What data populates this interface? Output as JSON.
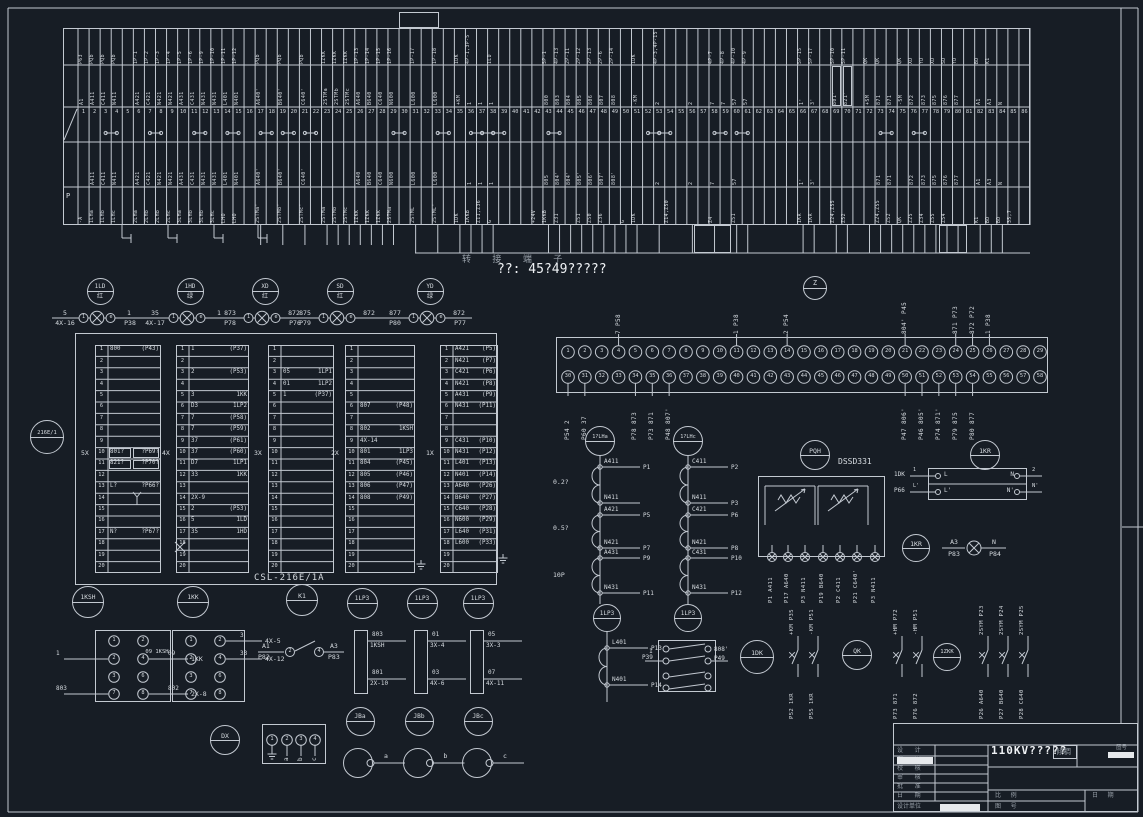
{
  "note_text": "??: 45?49?????",
  "bridge_text": "转 接 端 子",
  "strip": {
    "header_p": "P",
    "jumpers": [
      3,
      7,
      11,
      14,
      17,
      19,
      21,
      29,
      33,
      36,
      37,
      38,
      43,
      52,
      53,
      58,
      60,
      73,
      76
    ],
    "boxed": [
      69,
      70
    ],
    "columns": [
      [
        "1",
        "P63",
        "A1",
        "",
        "-A"
      ],
      [
        "2",
        "PQb",
        "A411",
        "A411",
        "1LHa"
      ],
      [
        "3",
        "PQb",
        "C411",
        "C411",
        "1LHb"
      ],
      [
        "4",
        "PQb",
        "N411",
        "N411",
        "1LHc"
      ],
      [
        "5",
        "",
        "",
        "",
        ""
      ],
      [
        "6",
        "1P-1",
        "A421",
        "A421",
        "2LHa"
      ],
      [
        "7",
        "1P-2",
        "C421",
        "C421",
        "2LHb"
      ],
      [
        "8",
        "1P-3",
        "N421",
        "N421",
        "2LHb"
      ],
      [
        "9",
        "1P-4",
        "N421",
        "N421",
        "2LHc"
      ],
      [
        "10",
        "1P-5",
        "A431",
        "A431",
        "3LHa"
      ],
      [
        "11",
        "1P-6",
        "C431",
        "C431",
        "3LHb"
      ],
      [
        "12",
        "1P-9",
        "N431",
        "N431",
        "3LHb"
      ],
      [
        "13",
        "1P-10",
        "N431",
        "N431",
        "3LHc"
      ],
      [
        "14",
        "1P-11",
        "L401",
        "L401",
        "LHO"
      ],
      [
        "15",
        "1P-12",
        "N401",
        "N401",
        "LHO"
      ],
      [
        "16",
        "",
        "",
        "",
        ""
      ],
      [
        "17",
        "PQb",
        "A640'",
        "A640'",
        "2STMa'"
      ],
      [
        "18",
        "",
        "",
        "",
        ""
      ],
      [
        "19",
        "PQb",
        "B640'",
        "B640'",
        "2STMb'"
      ],
      [
        "20",
        "",
        "",
        "",
        ""
      ],
      [
        "21",
        "PQb",
        "C640'",
        "C640'",
        "2STMc'"
      ],
      [
        "22",
        "",
        "",
        "",
        ""
      ],
      [
        "23",
        "1ZKK",
        "2STMa",
        "",
        "2STMa"
      ],
      [
        "24",
        "1ZKK",
        "2STMb",
        "",
        "2STMb"
      ],
      [
        "25",
        "1ZKK",
        "2STMc",
        "",
        "2STMc"
      ],
      [
        "26",
        "1P-13",
        "A640",
        "A640",
        "1ZKK"
      ],
      [
        "27",
        "1P-14",
        "B640",
        "B640",
        "1ZKK"
      ],
      [
        "28",
        "1P-15",
        "C640",
        "C640",
        "1ZKK"
      ],
      [
        "29",
        "1P-16",
        "N600",
        "N600",
        "2STMa"
      ],
      [
        "30",
        "",
        "",
        "",
        ""
      ],
      [
        "31",
        "1P-17",
        "L600",
        "L600",
        "2STML"
      ],
      [
        "32",
        "",
        "",
        "",
        ""
      ],
      [
        "33",
        "1P-18",
        "L600",
        "L600",
        "2STML'"
      ],
      [
        "34",
        "",
        "",
        "",
        ""
      ],
      [
        "35",
        "1DK",
        "+KM",
        "",
        "1DK"
      ],
      [
        "36",
        "4P-1,3P-5",
        "1",
        "1",
        "1KKB"
      ],
      [
        "37",
        "",
        "1",
        "1",
        "Z11,Z36"
      ],
      [
        "38",
        "1LD",
        "1",
        "1",
        "G"
      ],
      [
        "39",
        "",
        "",
        "",
        ""
      ],
      [
        "40",
        "",
        "",
        "",
        ""
      ],
      [
        "41",
        "",
        "",
        "",
        ""
      ],
      [
        "42",
        "",
        "",
        "",
        "+24V"
      ],
      [
        "43",
        "5P-1",
        "800",
        "805",
        "1KKB"
      ],
      [
        "44",
        "4P-13",
        "803",
        "804'",
        "Z31"
      ],
      [
        "45",
        "2P-11",
        "804",
        "804'",
        ""
      ],
      [
        "46",
        "2P-12",
        "805",
        "805'",
        "Z51"
      ],
      [
        "47",
        "2P-13",
        "806",
        "806'",
        "Z50"
      ],
      [
        "48",
        "2P-6",
        "807",
        "807'",
        "Z36"
      ],
      [
        "49",
        "2P-14",
        "808",
        "808'",
        ""
      ],
      [
        "50",
        "",
        "",
        "",
        "G"
      ],
      [
        "51",
        "1DK",
        "-KM",
        "",
        "1DK"
      ],
      [
        "52",
        "",
        "",
        "",
        ""
      ],
      [
        "53",
        "4P-3,4P-15",
        "2",
        "2",
        ""
      ],
      [
        "54",
        "",
        "",
        "",
        "Z14,Z50"
      ],
      [
        "55",
        "",
        "",
        "",
        ""
      ],
      [
        "56",
        "",
        "2",
        "2",
        ""
      ],
      [
        "57",
        "",
        "",
        "",
        ""
      ],
      [
        "58",
        "4P-7",
        "7",
        "7",
        "Z4"
      ],
      [
        "59",
        "4P-8",
        "7",
        "",
        ""
      ],
      [
        "60",
        "4P-10",
        "57",
        "57",
        "Z51"
      ],
      [
        "61",
        "4P-9",
        "57",
        "",
        ""
      ],
      [
        "62",
        "",
        "",
        "",
        ""
      ],
      [
        "63",
        "",
        "",
        "",
        ""
      ],
      [
        "64",
        "",
        "",
        "",
        ""
      ],
      [
        "65",
        "",
        "",
        "",
        ""
      ],
      [
        "66",
        "5P-15",
        "1'",
        "1'",
        "1KR"
      ],
      [
        "67",
        "5P-17",
        "3'",
        "3'",
        "1KR"
      ],
      [
        "68",
        "",
        "",
        "",
        ""
      ],
      [
        "69",
        "5P-10",
        "801'",
        "",
        "Z24,Z55"
      ],
      [
        "70",
        "5P-11",
        "821'",
        "",
        "Z52"
      ],
      [
        "71",
        "",
        "",
        "",
        ""
      ],
      [
        "72",
        "QK",
        "+SM",
        "",
        ""
      ],
      [
        "73",
        "QK",
        "871",
        "871",
        "Z24,Z55"
      ],
      [
        "74",
        "",
        "871",
        "871",
        "Z52"
      ],
      [
        "75",
        "QK",
        "-SM",
        "",
        "QK"
      ],
      [
        "76",
        "XD",
        "872",
        "872",
        "Z25"
      ],
      [
        "77",
        "YD",
        "873",
        "873",
        "Z34"
      ],
      [
        "78",
        "XD",
        "875",
        "875",
        "Z55"
      ],
      [
        "79",
        "SD",
        "876",
        "876",
        "Z54"
      ],
      [
        "80",
        "YD",
        "877",
        "877",
        ""
      ],
      [
        "81",
        "",
        "",
        "",
        ""
      ],
      [
        "82",
        "BD",
        "A1",
        "A1",
        "K1"
      ],
      [
        "83",
        "K1",
        "A3",
        "A3",
        "BD"
      ],
      [
        "84",
        "",
        "N",
        "N",
        "BD"
      ],
      [
        "85",
        "",
        "",
        "",
        "35,7"
      ],
      [
        "86",
        "",
        "",
        "",
        ""
      ]
    ]
  },
  "lamps": [
    {
      "id": "1LD",
      "ch": "红",
      "lt": "5",
      "lb": "4X-16",
      "rt": "1",
      "rb": "P38"
    },
    {
      "id": "1HD",
      "ch": "绿",
      "lt": "35",
      "lb": "4X-17",
      "rt": "1",
      "rb": ""
    },
    {
      "id": "XD",
      "ch": "红",
      "lt": "873",
      "lb": "P78",
      "rt": "872",
      "rb": "P76"
    },
    {
      "id": "SD",
      "ch": "红",
      "lt": "875",
      "lb": "P79",
      "rt": "872",
      "rb": ""
    },
    {
      "id": "YD",
      "ch": "绿",
      "lt": "877",
      "lb": "P80",
      "rt": "872",
      "rb": "P77"
    }
  ],
  "device_left": "216E/1",
  "blocks": {
    "footer": "CSL-216E/1A",
    "items": [
      {
        "id": "5X",
        "x": 95,
        "w": 66,
        "rows": {
          "1": [
            "800",
            "(P43)"
          ],
          "10": [
            "801?",
            "?P69?",
            "box"
          ],
          "11": [
            "821?",
            "?P70?",
            "box"
          ],
          "13": [
            "L?",
            "?P66?"
          ],
          "17": [
            "N?",
            "?P67?"
          ]
        }
      },
      {
        "id": "4X",
        "x": 176,
        "w": 73,
        "rows": {
          "1": [
            "1",
            "(P37)"
          ],
          "3": [
            "2",
            "(P53)"
          ],
          "5": [
            "3",
            "1KK"
          ],
          "6": [
            "D3",
            "1LP2"
          ],
          "7": [
            "7",
            "(P58)"
          ],
          "8": [
            "7",
            "(P59)"
          ],
          "9": [
            "37",
            "(P61)"
          ],
          "10": [
            "37",
            "(P60)"
          ],
          "11": [
            "D7",
            "1LP1"
          ],
          "12": [
            "33",
            "1KK"
          ],
          "14": [
            "2X-9",
            ""
          ],
          "15": [
            "2",
            "(P53)"
          ],
          "16": [
            "5",
            "1LD"
          ],
          "17": [
            "35",
            "1HD"
          ]
        }
      },
      {
        "id": "3X",
        "x": 268,
        "w": 66,
        "rows": {
          "3": [
            "05",
            "1LP1"
          ],
          "4": [
            "01",
            "1LP2"
          ],
          "5": [
            "1",
            "(P37)"
          ]
        }
      },
      {
        "id": "2X",
        "x": 345,
        "w": 70,
        "rows": {
          "6": [
            "807",
            "(P48)"
          ],
          "8": [
            "802",
            "1KSH"
          ],
          "9": [
            "4X-14",
            ""
          ],
          "10": [
            "801",
            "1LP3"
          ],
          "11": [
            "804",
            "(P45)"
          ],
          "12": [
            "805",
            "(P46)"
          ],
          "13": [
            "806",
            "(P47)"
          ],
          "14": [
            "808",
            "(P49)"
          ]
        }
      },
      {
        "id": "1X",
        "x": 440,
        "w": 58,
        "rows": {
          "1": [
            "A421",
            "(P5)"
          ],
          "2": [
            "N421",
            "(P7)"
          ],
          "3": [
            "C421",
            "(P6)"
          ],
          "4": [
            "N421",
            "(P8)"
          ],
          "5": [
            "A431",
            "(P9)"
          ],
          "6": [
            "N431",
            "(P11)"
          ],
          "9": [
            "C431",
            "(P10)"
          ],
          "10": [
            "N431",
            "(P12)"
          ],
          "11": [
            "L401",
            "(P13)"
          ],
          "12": [
            "N401",
            "(P14)"
          ],
          "13": [
            "A640",
            "(P26)"
          ],
          "14": [
            "B640",
            "(P27)"
          ],
          "15": [
            "C640",
            "(P28)"
          ],
          "16": [
            "N600",
            "(P29)"
          ],
          "17": [
            "L640",
            "(P31)"
          ],
          "18": [
            "L600",
            "(P33)"
          ]
        }
      }
    ]
  },
  "connector": {
    "z_label": "Z",
    "top_callouts": [
      [
        4,
        "7 P58"
      ],
      [
        11,
        "1 P38"
      ],
      [
        14,
        "2 P54"
      ],
      [
        21,
        "804' P45"
      ],
      [
        24,
        "871 P73"
      ],
      [
        25,
        "872 P72"
      ],
      [
        26,
        "1 P38"
      ]
    ],
    "bottom_callouts": [
      [
        30,
        "P54 2"
      ],
      [
        31,
        "P60 37"
      ],
      [
        34,
        "P78 873"
      ],
      [
        35,
        "P73 871"
      ],
      [
        36,
        "P48 807'"
      ],
      [
        50,
        "P47 806'"
      ],
      [
        51,
        "P46 805'"
      ],
      [
        52,
        "P74 871'"
      ],
      [
        53,
        "P79 875"
      ],
      [
        54,
        "P80 877"
      ]
    ]
  },
  "transformers": {
    "ratings": [
      "0.2?",
      "0.5?",
      "10P"
    ],
    "left": {
      "id": "1?LHa",
      "taps": [
        [
          "A411",
          "P1"
        ],
        [
          "N411",
          ""
        ],
        [
          "A421",
          "P5"
        ],
        [
          "N421",
          "P7"
        ],
        [
          "A431",
          "P9"
        ],
        [
          "N431",
          "P11"
        ]
      ]
    },
    "right": {
      "id": "1?LHc",
      "taps": [
        [
          "C411",
          "P2"
        ],
        [
          "N411",
          "P3"
        ],
        [
          "C421",
          "P6"
        ],
        [
          "N421",
          "P8"
        ],
        [
          "C431",
          "P10"
        ],
        [
          "N431",
          "P12"
        ]
      ]
    }
  },
  "lp_winding": {
    "id": "1LP3",
    "taps": [
      [
        "L401",
        "P13"
      ],
      [
        "N401",
        "P14"
      ]
    ]
  },
  "aux_switch": {
    "id": "1LP3",
    "left_top": "1",
    "left_bot": "P39",
    "right_top": "808'",
    "right_bot": "P49"
  },
  "meter": {
    "id": "PQH",
    "model": "DSSD331",
    "terminals": [
      [
        "A411",
        "P1"
      ],
      [
        "A640",
        "P17"
      ],
      [
        "N411",
        "P3"
      ],
      [
        "B640",
        "P19"
      ],
      [
        "C411",
        "P2"
      ],
      [
        "C640'",
        "P21"
      ],
      [
        "N411",
        "P3"
      ]
    ]
  },
  "relay_box": {
    "rows": [
      [
        "1DK",
        "1",
        "L",
        "N",
        "2"
      ],
      [
        "P66",
        "L'",
        "L'",
        "N'",
        "N'"
      ]
    ]
  },
  "kr1": "1KR",
  "kr2": "1KR",
  "pilot": {
    "lt": "A3",
    "lb": "P83",
    "rt": "N",
    "rb": "P84"
  },
  "ksh": {
    "id": "1KSH",
    "pins": [
      [
        "1",
        "2"
      ],
      [
        "2",
        "4"
      ],
      [
        "3",
        "6"
      ],
      [
        "7",
        "8"
      ]
    ],
    "left": [
      [
        "1",
        1
      ],
      [
        "803",
        3
      ]
    ],
    "right": [
      [
        "09",
        "1KK",
        1
      ],
      [
        "802",
        "2X-8",
        3
      ]
    ]
  },
  "kk": {
    "id": "1KK",
    "pins": [
      [
        "1",
        "2"
      ],
      [
        "2",
        "4"
      ],
      [
        "3",
        "6"
      ],
      [
        "7",
        "8"
      ]
    ],
    "left": [
      [
        "09 1KSH",
        1
      ]
    ],
    "right": [
      [
        "3",
        "4X-5",
        0
      ],
      [
        "33",
        "4X-12",
        1
      ]
    ]
  },
  "k1": {
    "id": "K1",
    "lt": "A1",
    "lb": "P82",
    "p1": "2",
    "p2": "4",
    "rt": "A3",
    "rb": "P83"
  },
  "links": {
    "ids": [
      "1LP3",
      "1LP3",
      "1LP3"
    ],
    "boxes": [
      [
        [
          "803",
          "1KSH"
        ],
        [
          "801",
          "2X-10"
        ]
      ],
      [
        [
          "01",
          "3X-4"
        ],
        [
          "03",
          "4X-6"
        ]
      ],
      [
        [
          "05",
          "3X-3"
        ],
        [
          "07",
          "4X-11"
        ]
      ]
    ]
  },
  "dk": "1DK",
  "qk": "QK",
  "zkk": "1ZKK",
  "dx": "DX",
  "contacts": [
    {
      "x": 798,
      "top": "+KM P35",
      "bot": "P52 1KR"
    },
    {
      "x": 818,
      "top": "-KM P51",
      "bot": "P55 1KR"
    },
    {
      "x": 902,
      "top": "+HM P72",
      "bot": "P73 871"
    },
    {
      "x": 922,
      "top": "-HM P51",
      "bot": "P76 872"
    },
    {
      "x": 988,
      "top": "2SYM P23",
      "bot": "P26 A640"
    },
    {
      "x": 1008,
      "top": "2SYM P24",
      "bot": "P27 B640"
    },
    {
      "x": 1028,
      "top": "2SYM P25",
      "bot": "P28 C640"
    }
  ],
  "dx_box": {
    "pins": [
      "1",
      "2",
      "3",
      "4"
    ],
    "subs": [
      "a",
      "b",
      "c"
    ]
  },
  "jb": {
    "ids": [
      "JBa",
      "JBb",
      "JBc"
    ],
    "phases": [
      "a",
      "b",
      "c"
    ]
  },
  "title_block": {
    "title": "110KV?????",
    "tag": "倾稠",
    "top_right": "图号",
    "left_rows": [
      "设 计",
      "制 图",
      "校 核",
      "审 核",
      "批 准",
      "日 期"
    ],
    "bottom_left": "设计单位",
    "br_row1_a": "比 例",
    "br_row1_b": "日 期",
    "br_row2_a": "图 号"
  }
}
